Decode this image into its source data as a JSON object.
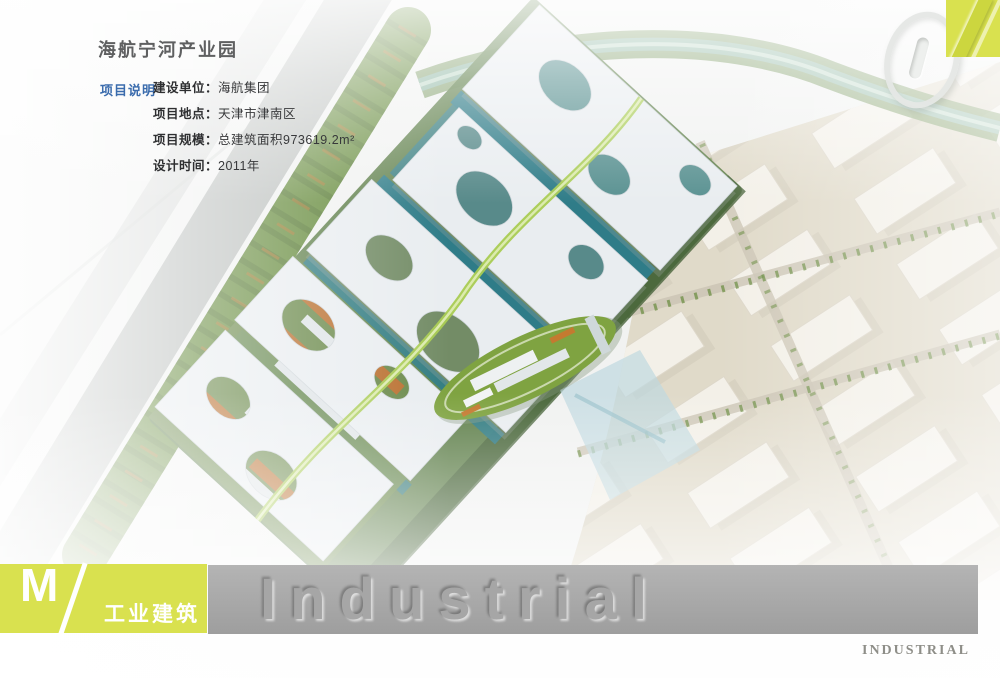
{
  "header": {
    "title": "海航宁河产业园",
    "section_label": "项目说明",
    "details": [
      {
        "label": "建设单位：",
        "value": "海航集团"
      },
      {
        "label": "项目地点：",
        "value": "天津市津南区"
      },
      {
        "label": "项目规模：",
        "value": "总建筑面积973619.2m²"
      },
      {
        "label": "设计时间：",
        "value": "2011年"
      }
    ]
  },
  "page_corner": {
    "number": "01"
  },
  "footer": {
    "category_letter": "M",
    "category_label": "工业建筑",
    "watermark": "Industrial",
    "corner_text": "INDUSTRIAL"
  },
  "colors": {
    "accent": "#d9e14f",
    "label_blue": "#3b6cad",
    "bar_gray": "#a8a8a8",
    "canopy_white": "#e9edf0",
    "glass_teal": "#35858f"
  }
}
